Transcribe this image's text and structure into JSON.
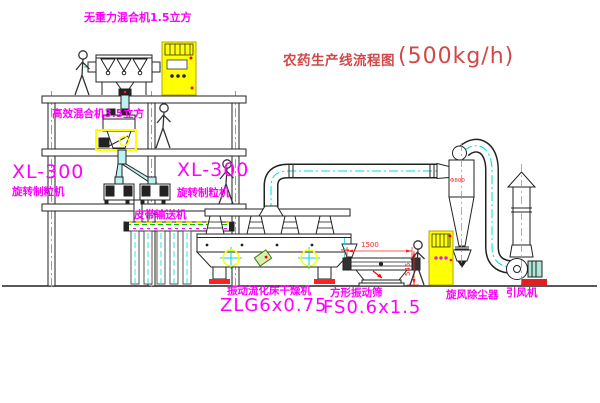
{
  "title": {
    "text_cn": "农药生产线流程图",
    "capacity": "(500kg/h)"
  },
  "equipment_labels": {
    "gravity_mixer": "无重力混合机1.5立方",
    "high_eff_mixer": "高效混合机3.5立方",
    "granulator_left_model": "XL-300",
    "granulator_left_name": "旋转制粒机",
    "granulator_right_model": "XL-300",
    "granulator_right_name": "旋转制粒机",
    "belt_conveyor": "皮带输送机",
    "fluid_bed_dryer_name": "振动流化床干燥机",
    "fluid_bed_dryer_model": "ZLG6x0.75",
    "vibrating_sieve_name": "方形振动筛",
    "vibrating_sieve_model": "FS0.6x1.5",
    "cyclone": "旋风除尘器",
    "induced_draft_fan": "引风机"
  },
  "dimensions": {
    "sieve_length_mm": "1500",
    "sieve_height_mm": "545",
    "cyclone_marking": "Φ800"
  },
  "colors": {
    "label_magenta": "#ff00ff",
    "title_red": "#d24848",
    "dimension_red": "#ff2020",
    "centerline_cyan": "#00dcdc",
    "cabinet_yellow": "#ffff00",
    "chute_cyan": "#bdf2f2",
    "line_black": "#222222"
  }
}
